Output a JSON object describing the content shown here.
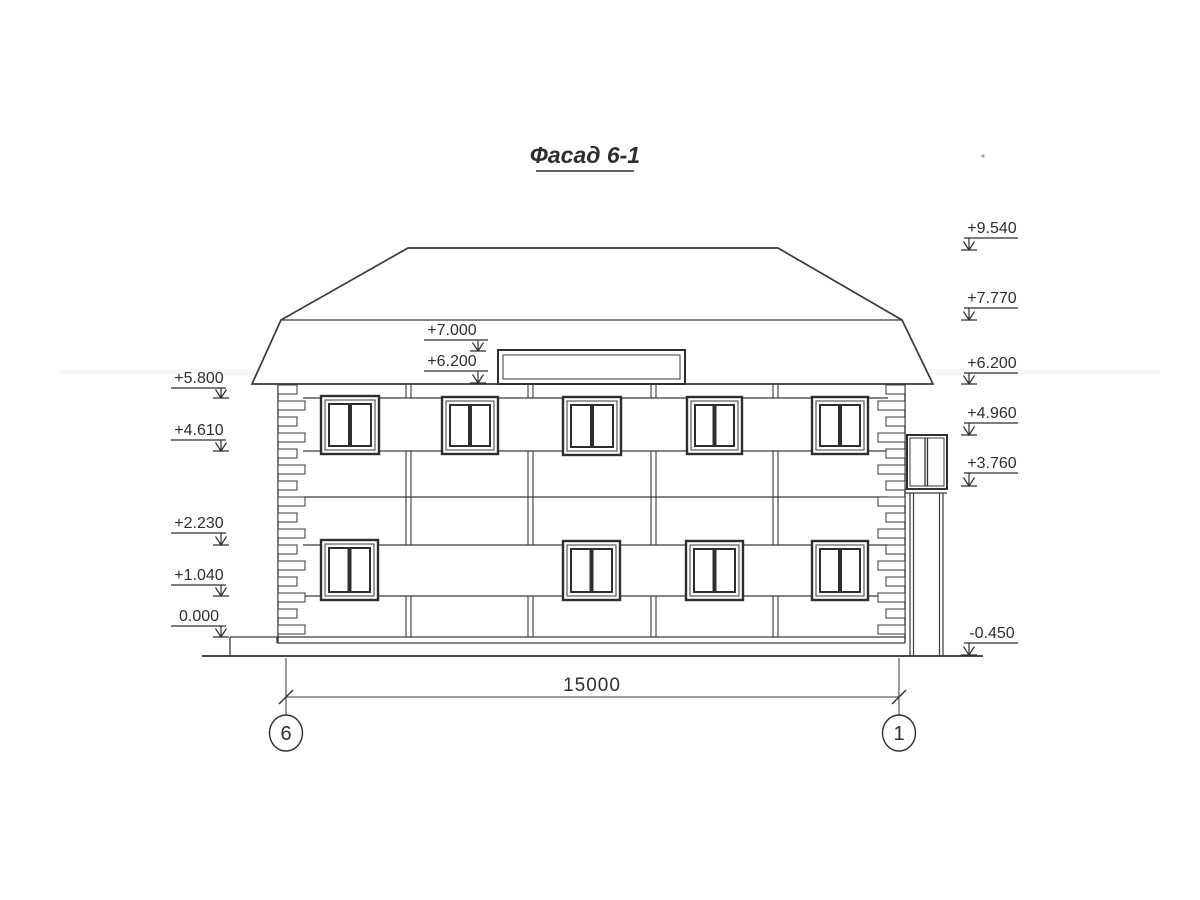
{
  "title": "Фасад 6-1",
  "elevation_marks": {
    "right": [
      "+9.540",
      "+7.770",
      "+6.200",
      "+4.960",
      "+3.760",
      "-0.450"
    ],
    "left": [
      "+5.800",
      "+4.610",
      "+2.230",
      "+1.040",
      "0.000"
    ],
    "middle": [
      "+7.000",
      "+6.200"
    ]
  },
  "dimension": {
    "length_label": "15000"
  },
  "axes": {
    "left": "6",
    "right": "1"
  },
  "colors": {
    "ink": "#3a3a3a",
    "paper": "#ffffff"
  }
}
